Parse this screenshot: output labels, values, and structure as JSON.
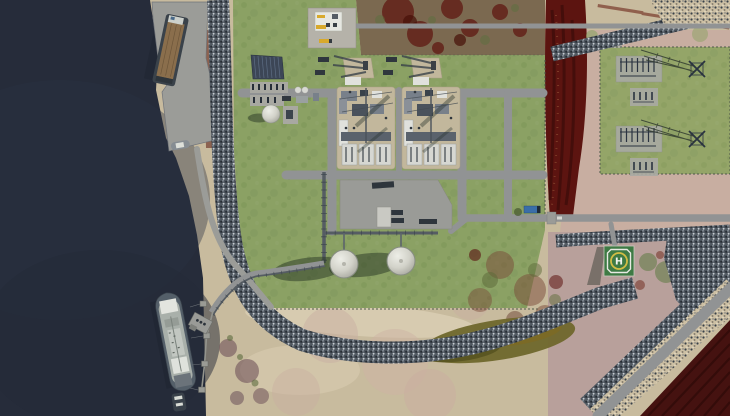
{
  "labels": {
    "helipad_marking": "H"
  },
  "colors": {
    "water": "#262c3a",
    "waterLight": "#2b3244",
    "grass": "#8ba164",
    "grassDark": "#6d8749",
    "sand": "#c8bb9e",
    "sandLight": "#dbcfb4",
    "sandPink": "#c8aca1",
    "mauve": "#b49a9a",
    "road": "#919394",
    "concrete": "#9b9c98",
    "padLight": "#b5b2a9",
    "trainPad": "#c2b79c",
    "equip": "#78808a",
    "equipDark": "#39424a",
    "white": "#e0e1dc",
    "redVeg": "#5c1410",
    "redVegDark": "#3f0c0a",
    "mottle": "#7b6950",
    "fieldMaroon": "#451210",
    "fieldLine": "#2d0a08",
    "pond": "#6f672c",
    "pondDark": "#565220",
    "solar": "#3c4656",
    "solarLine": "#5d6d83",
    "yellow": "#d8a92c",
    "heliGreen": "#3e7a44",
    "heliYellow": "#d2bd44",
    "shipHull": "#545f69",
    "shipDeck": "#aeb4ae",
    "bargeHull": "#3a424a",
    "bargeDeck": "#8a6e4c",
    "truckBlue": "#3a6ea8",
    "truckDark": "#2e353c",
    "pipe": "#555c63",
    "fence": "#4e584a",
    "shadow": "rgba(40,54,36,0.5)"
  }
}
